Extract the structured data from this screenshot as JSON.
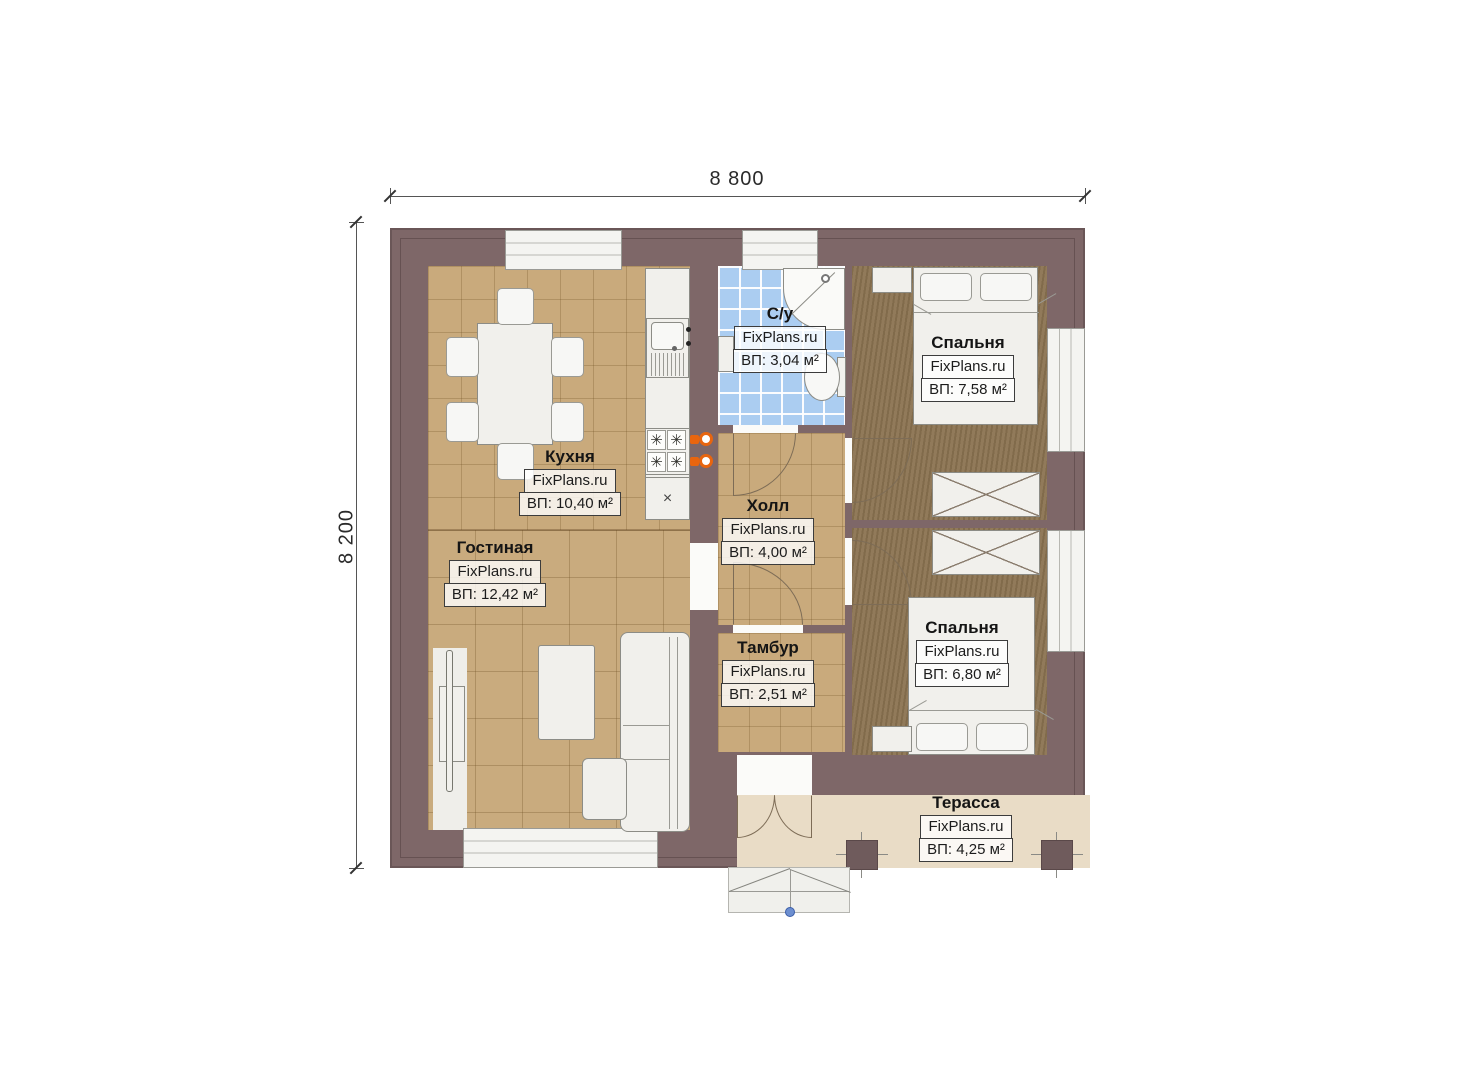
{
  "dimensions": {
    "width": "8 800",
    "height": "8 200"
  },
  "watermark": "FixPlans.ru",
  "rooms": [
    {
      "name": "Кухня",
      "area": "ВП: 10,40 м²"
    },
    {
      "name": "Гостиная",
      "area": "ВП: 12,42 м²"
    },
    {
      "name": "С/у",
      "area": "ВП: 3,04 м²"
    },
    {
      "name": "Холл",
      "area": "ВП: 4,00 м²"
    },
    {
      "name": "Тамбур",
      "area": "ВП: 2,51 м²"
    },
    {
      "name": "Спальня",
      "area": "ВП: 7,58 м²"
    },
    {
      "name": "Спальня",
      "area": "ВП: 6,80 м²"
    },
    {
      "name": "Терасса",
      "area": "ВП: 4,25 м²"
    }
  ],
  "glyphs": {
    "burner": "✳",
    "cabinet_x": "×"
  },
  "colors": {
    "wall": "#7e6768",
    "floor_tile": "#c9aa7c",
    "floor_bath": "#abcdf1",
    "floor_wood": "#8b7351",
    "floor_terrace": "#e9dcc6",
    "knob_orange": "#e8650f",
    "marker_blue": "#6d8fd0"
  }
}
